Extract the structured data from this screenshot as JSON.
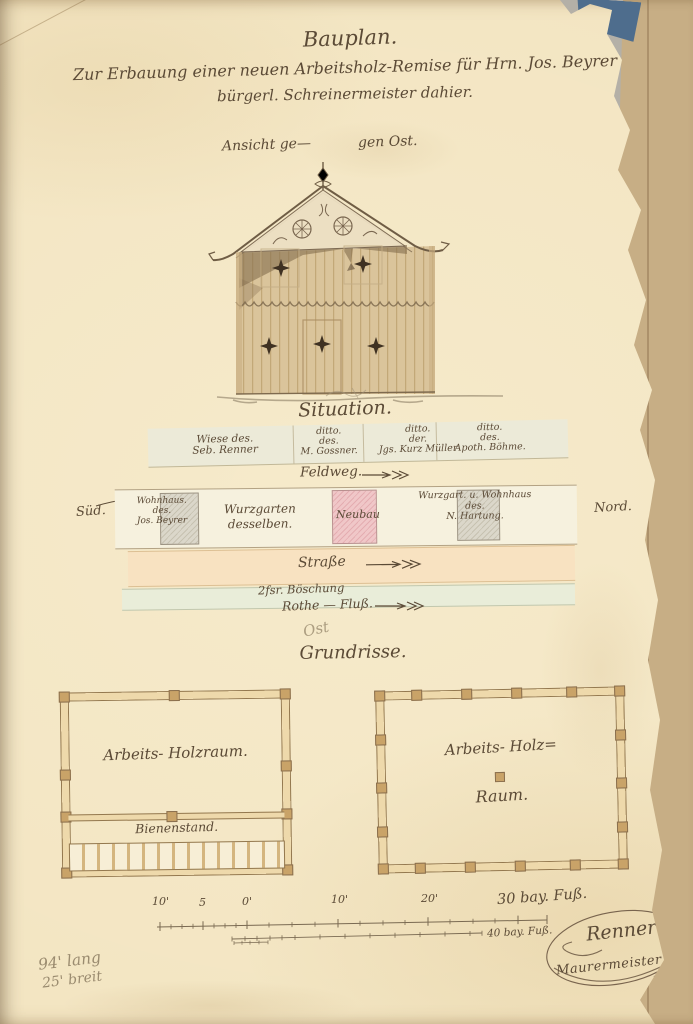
{
  "header": {
    "line1": "Bauplan.",
    "line2": "Zur Erbauung einer neuen Arbeitsholz-Remise für Hrn. Jos. Beyrer",
    "line3": "bürgerl. Schreinermeister dahier."
  },
  "elevation": {
    "caption_left": "Ansicht ge—",
    "caption_right": "gen Ost."
  },
  "situation": {
    "heading": "Situation.",
    "north_plots": [
      {
        "lines": [
          "Wiese des.",
          "Seb. Renner"
        ]
      },
      {
        "lines": [
          "ditto.",
          "des.",
          "M. Gossner."
        ]
      },
      {
        "lines": [
          "ditto.",
          "der.",
          "Jgs. Kurz Müller"
        ]
      },
      {
        "lines": [
          "ditto.",
          "des.",
          "Apoth. Böhme."
        ]
      }
    ],
    "feldweg": "Feldweg.",
    "sued": "Süd.",
    "nord": "Nord.",
    "wohnhaus_lines": [
      "Wohnhaus.",
      "des.",
      "Jos. Beyrer"
    ],
    "wurzgarten_lines": [
      "Wurzgarten",
      "desselben."
    ],
    "neubau": "Neubau",
    "hartung_lines": [
      "Wurzgart. u. Wohnhaus",
      "des.",
      "N. Hartung."
    ],
    "strasse": "Straße",
    "boeschung": "2fsr. Böschung",
    "fluss": "Rothe — Fluß.",
    "ost_pencil": "Ost"
  },
  "plans": {
    "heading": "Grundrisse.",
    "left_room": "Arbeits- Holzraum.",
    "left_bottom": "Bienenstand.",
    "right_room_line1": "Arbeits- Holz=",
    "right_room_line2": "Raum."
  },
  "scale": {
    "upper_ticks": [
      "10'",
      "5",
      "0'",
      "10'",
      "20'"
    ],
    "upper_end": "30 bay. Fuß.",
    "lower_end": "40 bay. Fuß."
  },
  "signature": {
    "name": "Renner",
    "title": "Maurermeister"
  },
  "notes": {
    "pencil_line1": "94' lang",
    "pencil_line2": "25' breit"
  },
  "colors": {
    "paper": "#f3e5c2",
    "ink": "#5b4a36",
    "pencil": "#9a8b6f",
    "building_tan": "#dac49b",
    "roof_shadow": "#86704f",
    "neubau_pink": "#f0c7c8",
    "plot_gray": "#dbd7ca",
    "strasse_peach": "#f8e2c1",
    "boeschung_green": "#e9edd9",
    "backing_tan": "#c7ae85",
    "scan_gray": "#b4b0a7",
    "fragment_blue": "#4e6d8d"
  }
}
